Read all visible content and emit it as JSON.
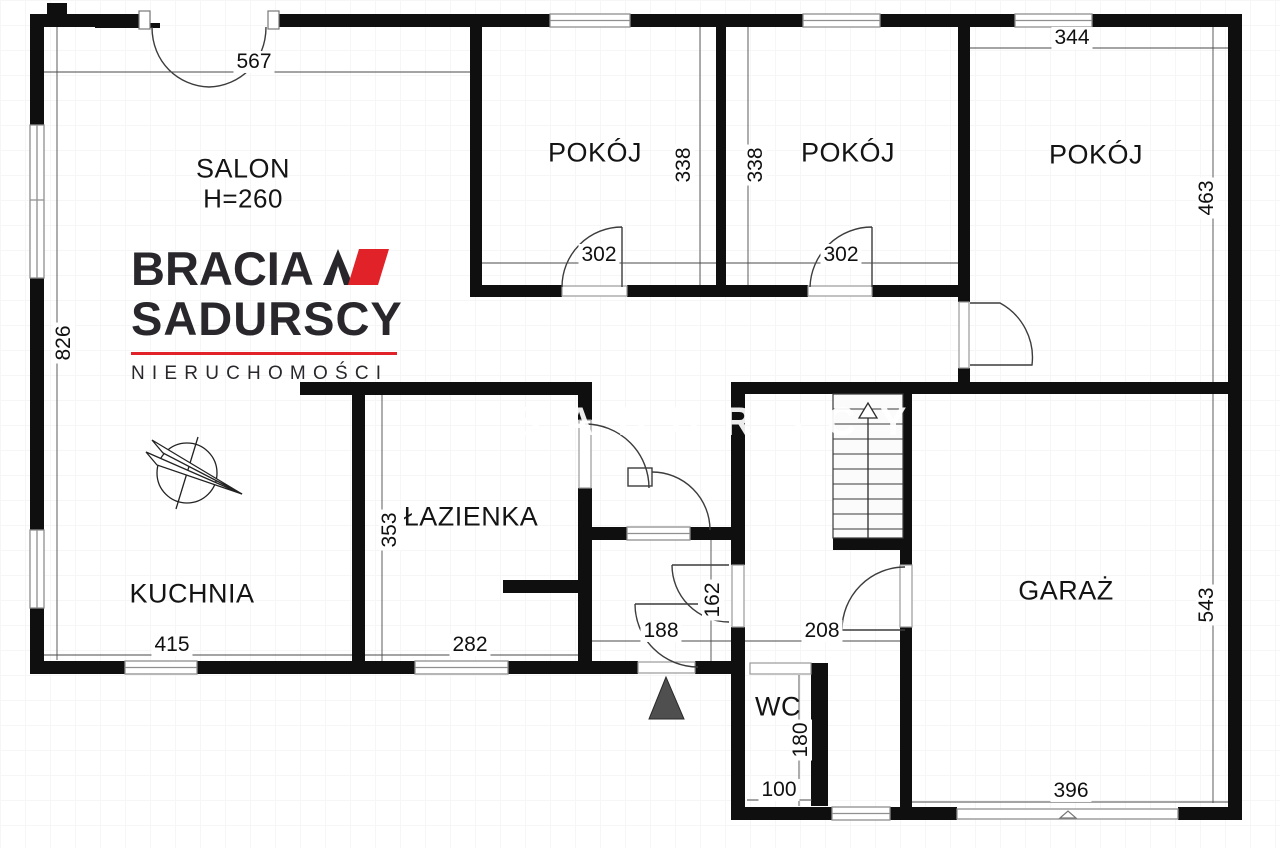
{
  "watermark": {
    "text": "SADURSCY"
  },
  "logo": {
    "line1": "BRACIA",
    "line2": "SADURSCY",
    "line3": "NIERUCHOMOŚCI",
    "accent_color": "#e22229",
    "text_color": "#29272b"
  },
  "plan": {
    "rooms": [
      {
        "id": "salon",
        "label": "SALON",
        "sub": "H=260",
        "x": 243,
        "y": 184
      },
      {
        "id": "pokoj-1",
        "label": "POKÓJ",
        "sub": "",
        "x": 595,
        "y": 153
      },
      {
        "id": "pokoj-2",
        "label": "POKÓJ",
        "sub": "",
        "x": 848,
        "y": 153
      },
      {
        "id": "pokoj-3",
        "label": "POKÓJ",
        "sub": "",
        "x": 1096,
        "y": 155
      },
      {
        "id": "lazienka",
        "label": "ŁAZIENKA",
        "sub": "",
        "x": 471,
        "y": 517
      },
      {
        "id": "kuchnia",
        "label": "KUCHNIA",
        "sub": "",
        "x": 192,
        "y": 594
      },
      {
        "id": "garaz",
        "label": "GARAŻ",
        "sub": "",
        "x": 1066,
        "y": 591
      },
      {
        "id": "wc",
        "label": "WC",
        "sub": "",
        "x": 778,
        "y": 707
      }
    ],
    "dimensions": [
      {
        "text": "567",
        "x": 254,
        "y": 62,
        "vertical": false
      },
      {
        "text": "826",
        "x": 64,
        "y": 343,
        "vertical": true
      },
      {
        "text": "344",
        "x": 1072,
        "y": 38,
        "vertical": false
      },
      {
        "text": "463",
        "x": 1207,
        "y": 198,
        "vertical": true
      },
      {
        "text": "338",
        "x": 684,
        "y": 165,
        "vertical": true
      },
      {
        "text": "338",
        "x": 756,
        "y": 165,
        "vertical": true
      },
      {
        "text": "302",
        "x": 599,
        "y": 255,
        "vertical": false
      },
      {
        "text": "302",
        "x": 841,
        "y": 255,
        "vertical": false
      },
      {
        "text": "353",
        "x": 390,
        "y": 530,
        "vertical": true
      },
      {
        "text": "415",
        "x": 172,
        "y": 645,
        "vertical": false
      },
      {
        "text": "282",
        "x": 470,
        "y": 645,
        "vertical": false
      },
      {
        "text": "188",
        "x": 661,
        "y": 631,
        "vertical": false
      },
      {
        "text": "208",
        "x": 822,
        "y": 631,
        "vertical": false
      },
      {
        "text": "162",
        "x": 713,
        "y": 600,
        "vertical": true
      },
      {
        "text": "543",
        "x": 1207,
        "y": 605,
        "vertical": true
      },
      {
        "text": "396",
        "x": 1071,
        "y": 791,
        "vertical": false
      },
      {
        "text": "100",
        "x": 779,
        "y": 790,
        "vertical": false
      },
      {
        "text": "180",
        "x": 801,
        "y": 740,
        "vertical": true
      }
    ]
  }
}
